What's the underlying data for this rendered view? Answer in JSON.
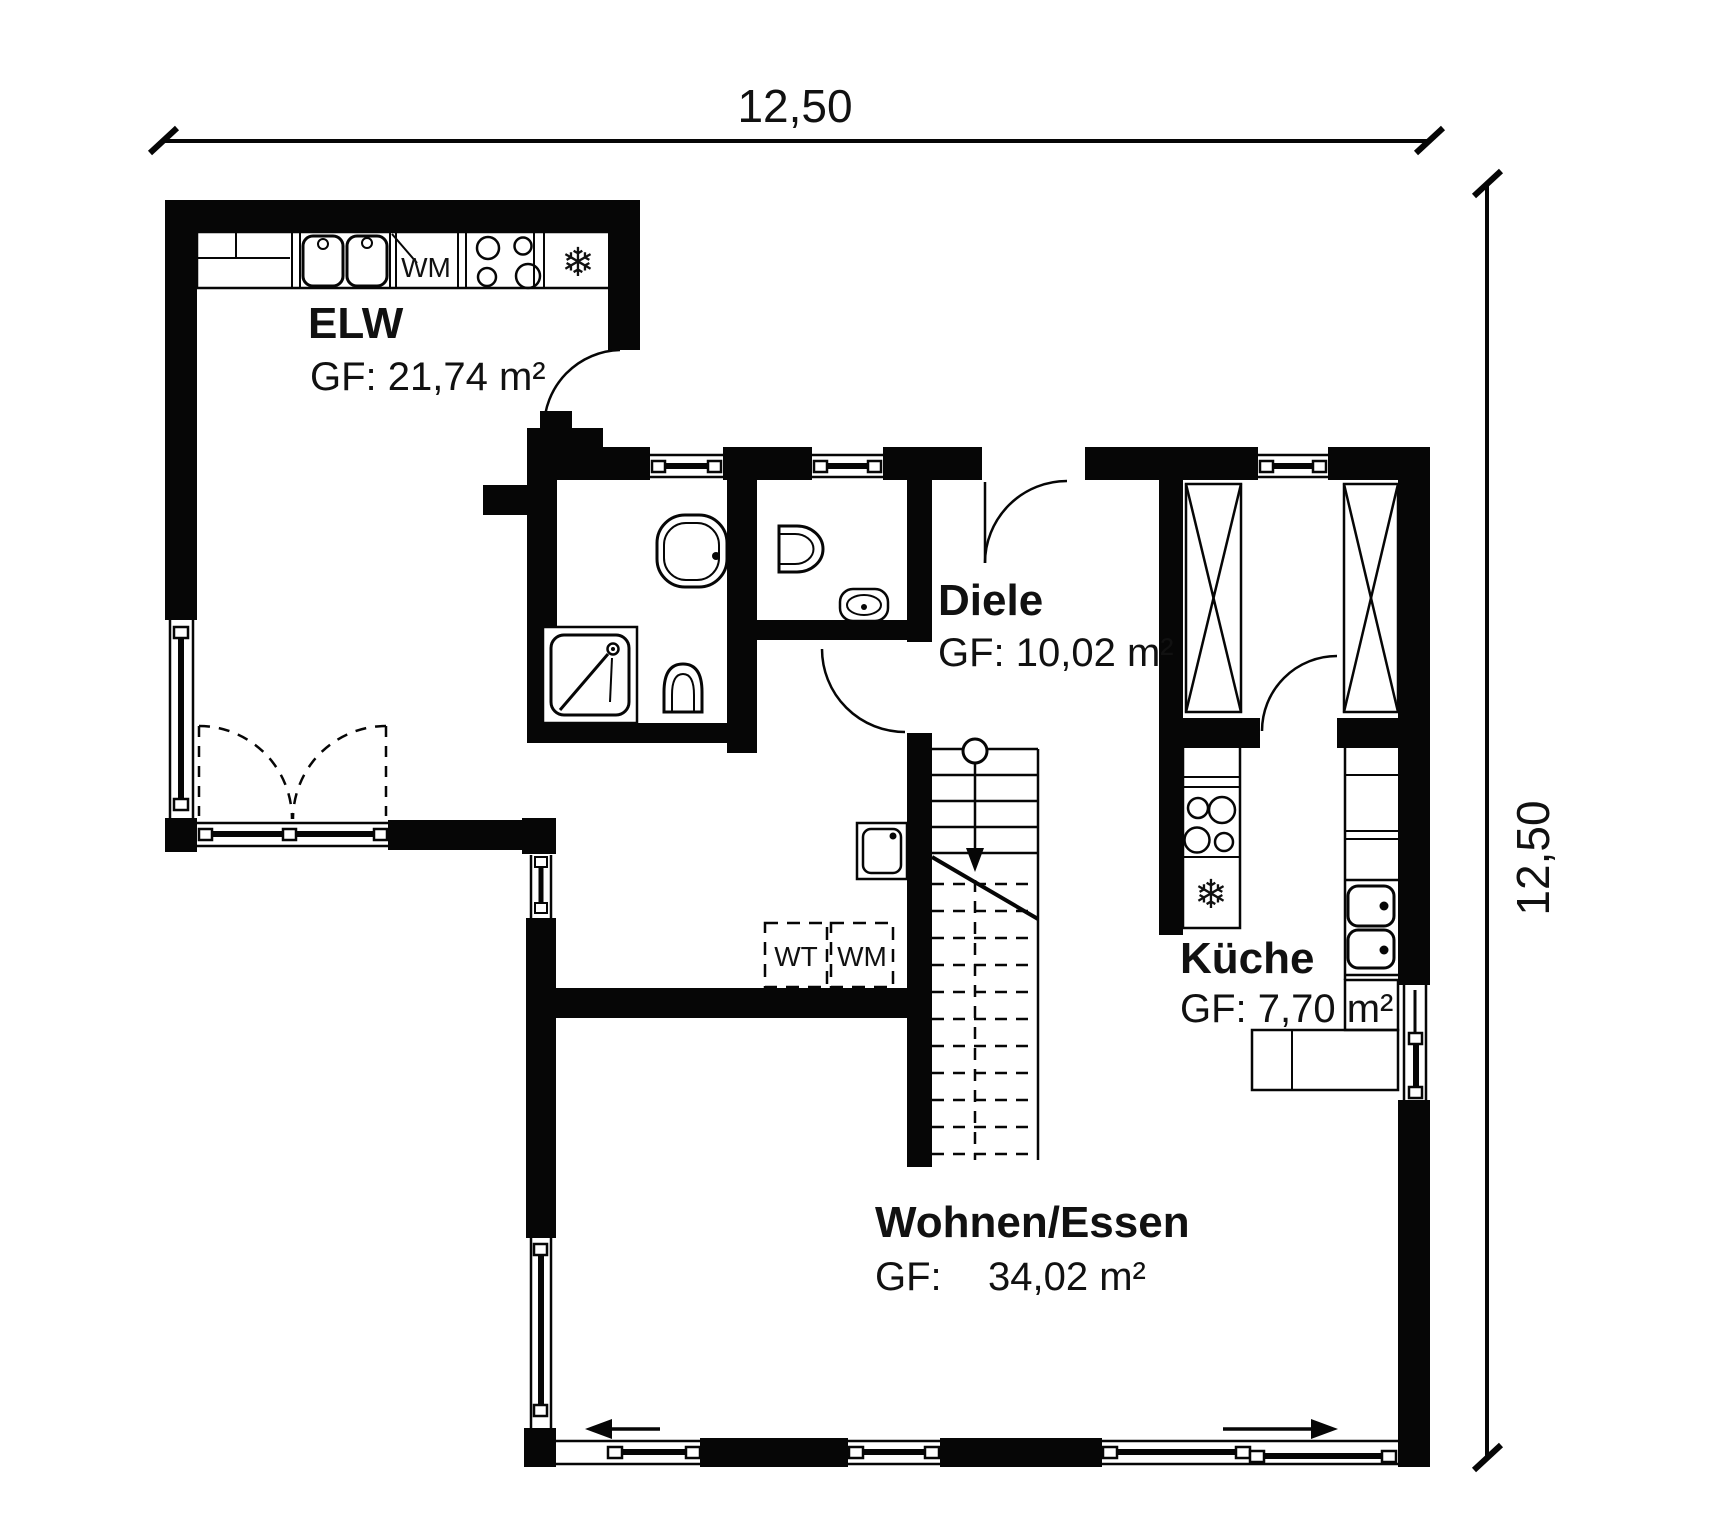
{
  "dimensions": {
    "width_label": "12,50",
    "height_label": "12,50"
  },
  "rooms": {
    "elw": {
      "name": "ELW",
      "area": "GF: 21,74 m²"
    },
    "diele": {
      "name": "Diele",
      "area": "GF: 10,02 m²"
    },
    "kueche": {
      "name": "Küche",
      "area": "GF: 7,70 m²"
    },
    "wohnen_essen": {
      "name": "Wohnen/Essen",
      "area_label": "GF:",
      "area_value": "34,02 m²"
    }
  },
  "labels": {
    "washing_machine_elw": "WM",
    "washing_dryer_hall": "WT",
    "washing_machine_hall": "WM",
    "fridge_symbol": "❄"
  }
}
